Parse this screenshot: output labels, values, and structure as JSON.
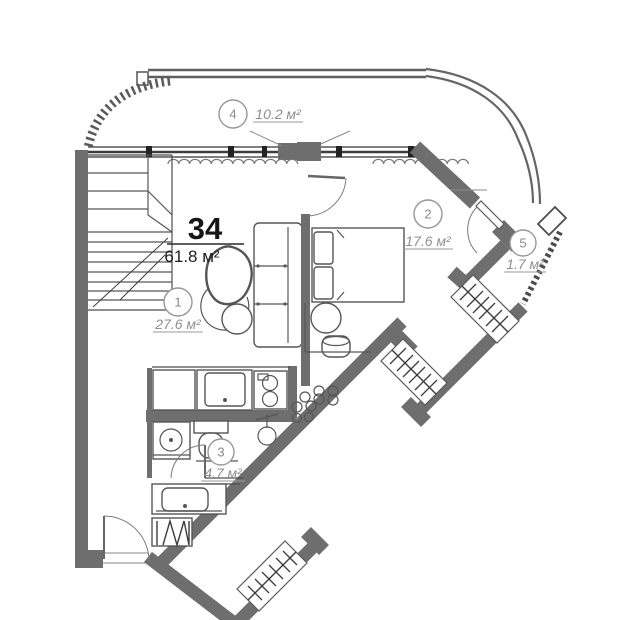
{
  "plan": {
    "apartment_number": "34",
    "total_area": "61.8 м²",
    "rooms": [
      {
        "number": "1",
        "area": "27.6 м²",
        "name": "living-room"
      },
      {
        "number": "2",
        "area": "17.6 м²",
        "name": "bedroom"
      },
      {
        "number": "3",
        "area": "4.7 м²",
        "name": "bathroom"
      },
      {
        "number": "4",
        "area": "10.2 м²",
        "name": "balcony"
      },
      {
        "number": "5",
        "area": "1.7 м²",
        "name": "loggia"
      }
    ],
    "colors": {
      "wall": "#6e6e6e",
      "furniture_line": "#565656",
      "label_gray": "#8f8f8f",
      "text_dark": "#161616",
      "background": "#ffffff"
    },
    "icons": [
      "stairs-icon",
      "sofa-icon",
      "armchair-icon",
      "bed-icon",
      "wardrobe-icon",
      "toilet-icon",
      "washing-machine-icon",
      "sink-icon",
      "stove-icon",
      "radiator-icon",
      "door-swing-icon",
      "window-icon",
      "railing-icon",
      "shaft-dots-icon"
    ]
  }
}
